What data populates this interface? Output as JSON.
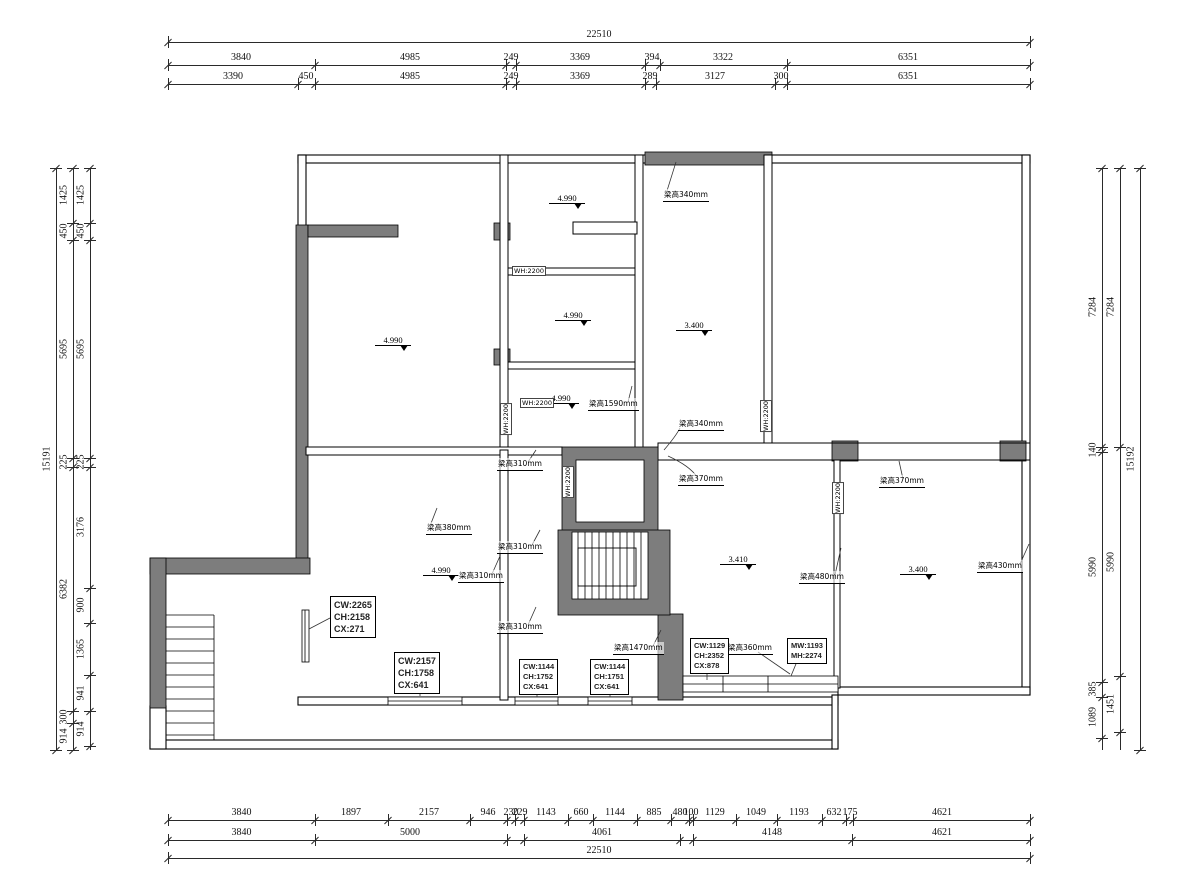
{
  "drawing": {
    "type": "floor-plan"
  },
  "dims": {
    "top": {
      "overall": "22510",
      "row2": [
        "3840",
        "4985",
        "249",
        "3369",
        "394",
        "3322",
        "6351"
      ],
      "row3": [
        "3390",
        "450",
        "4985",
        "249",
        "3369",
        "289",
        "3127",
        "300",
        "6351"
      ]
    },
    "bottom": {
      "row1": [
        "3840",
        "1897",
        "2157",
        "946",
        "230",
        "229",
        "1143",
        "660",
        "1144",
        "885",
        "480",
        "100",
        "1129",
        "1049",
        "1193",
        "632",
        "175",
        "4621"
      ],
      "row2": [
        "3840",
        "5000",
        "4061",
        "4148",
        "4621"
      ],
      "overall": "22510"
    },
    "left": {
      "overall": "15191",
      "mid": [
        "1425",
        "450",
        "5695",
        "225",
        "6382",
        "300",
        "914"
      ],
      "inner": [
        "1425",
        "450",
        "5695",
        "225",
        "3176",
        "900",
        "1365",
        "941",
        "914"
      ]
    },
    "right": {
      "inner": [
        "7284",
        "140",
        "5990",
        "385",
        "1089"
      ],
      "mid": [
        "7284",
        "5990",
        "1451"
      ],
      "overall": "15192"
    }
  },
  "levels": [
    "4.990",
    "4.990",
    "4.990",
    "4.990",
    "4.990",
    "3.400",
    "3.410",
    "3.400"
  ],
  "beams": [
    "梁高340mm",
    "梁高1590mm",
    "梁高340mm",
    "梁高370mm",
    "梁高310mm",
    "梁高380mm",
    "梁高310mm",
    "梁高310mm",
    "梁高310mm",
    "梁高1470mm",
    "梁高360mm",
    "梁高480mm",
    "梁高370mm",
    "梁高430mm"
  ],
  "wh_labels": [
    "WH:2200",
    "WH:2200",
    "WH:2200",
    "WH:2200",
    "WH:2200",
    "WH:2200"
  ],
  "boxes": [
    {
      "lines": [
        "CW:2265",
        "CH:2158",
        "CX:271"
      ]
    },
    {
      "lines": [
        "CW:2157",
        "CH:1758",
        "CX:641"
      ]
    },
    {
      "lines": [
        "CW:1144",
        "CH:1752",
        "CX:641"
      ]
    },
    {
      "lines": [
        "CW:1144",
        "CH:1751",
        "CX:641"
      ]
    },
    {
      "lines": [
        "CW:1129",
        "CH:2352",
        "CX:878"
      ]
    },
    {
      "lines": [
        "MW:1193",
        "MH:2274"
      ]
    }
  ],
  "colors": {
    "wall_gray": "#7d7d7d",
    "line": "#000000",
    "dim_text": "#111111"
  }
}
